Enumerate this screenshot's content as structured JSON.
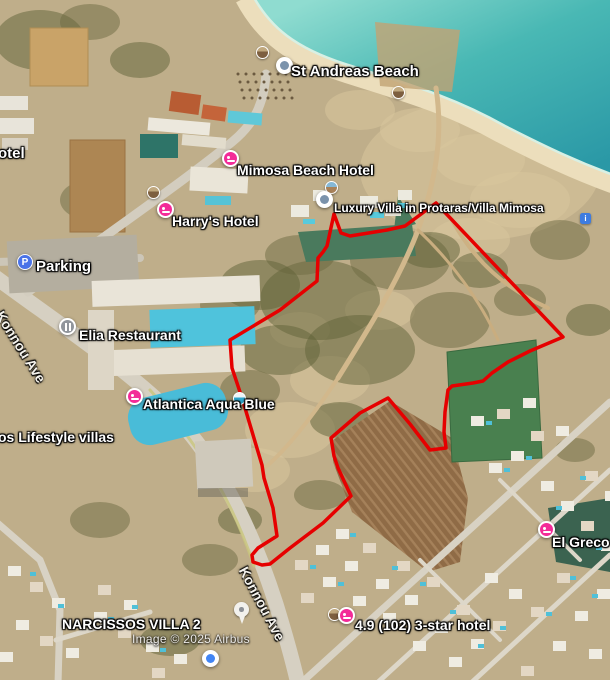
{
  "map": {
    "attribution": "Image © 2025 Airbus",
    "colors": {
      "parcel_outline": "#e60000",
      "hotel_pin": "#f32b98",
      "parking_pin": "#4a73e8",
      "restaurant_pin": "#90959c",
      "info_icon": "#3e7ce0",
      "sea_deep": "#2a98a6",
      "sea_shallow": "#8fdcd0",
      "terrain": "#bfae8a"
    },
    "parcel": {
      "points": [
        [
          436,
          203
        ],
        [
          563,
          337
        ],
        [
          530,
          351
        ],
        [
          508,
          362
        ],
        [
          492,
          373
        ],
        [
          483,
          381
        ],
        [
          473,
          383
        ],
        [
          452,
          386
        ],
        [
          448,
          390
        ],
        [
          445,
          412
        ],
        [
          444,
          432
        ],
        [
          446,
          448
        ],
        [
          430,
          450
        ],
        [
          410,
          424
        ],
        [
          388,
          398
        ],
        [
          360,
          413
        ],
        [
          331,
          438
        ],
        [
          334,
          456
        ],
        [
          338,
          468
        ],
        [
          351,
          496
        ],
        [
          323,
          523
        ],
        [
          290,
          548
        ],
        [
          270,
          564
        ],
        [
          262,
          565
        ],
        [
          253,
          562
        ],
        [
          252,
          555
        ],
        [
          258,
          548
        ],
        [
          277,
          536
        ],
        [
          273,
          508
        ],
        [
          264,
          478
        ],
        [
          262,
          465
        ],
        [
          242,
          398
        ],
        [
          232,
          368
        ],
        [
          230,
          340
        ],
        [
          280,
          310
        ],
        [
          317,
          281
        ],
        [
          318,
          258
        ],
        [
          323,
          252
        ],
        [
          327,
          246
        ],
        [
          334,
          214
        ],
        [
          341,
          233
        ],
        [
          350,
          236
        ],
        [
          387,
          230
        ],
        [
          405,
          226
        ]
      ]
    },
    "poi_labels": [
      {
        "id": "hotel-name-partial",
        "text": "otel",
        "x": -2,
        "y": 145,
        "size": 15
      },
      {
        "id": "st-andreas-beach",
        "text": "St Andreas Beach",
        "x": 291,
        "y": 63,
        "size": 15
      },
      {
        "id": "mimosa-beach-hotel",
        "text": "Mimosa Beach Hotel",
        "x": 237,
        "y": 162,
        "size": 14
      },
      {
        "id": "harrys-hotel",
        "text": "Harry's Hotel",
        "x": 172,
        "y": 213,
        "size": 14
      },
      {
        "id": "luxury-villa-protaras",
        "text": "Luxury Villa in Protaras/Villa Mimosa",
        "x": 334,
        "y": 201,
        "size": 12
      },
      {
        "id": "parking",
        "text": "Parking",
        "x": 36,
        "y": 258,
        "size": 15
      },
      {
        "id": "elia-restaurant",
        "text": "Elia Restaurant",
        "x": 79,
        "y": 327,
        "size": 14
      },
      {
        "id": "atlantica-aqua-blue",
        "text": "Atlantica Aqua Blue",
        "x": 143,
        "y": 396,
        "size": 14
      },
      {
        "id": "lifestyle-villas-partial",
        "text": "os Lifestyle villas",
        "x": -2,
        "y": 429,
        "size": 14
      },
      {
        "id": "el-greco",
        "text": "El Greco",
        "x": 552,
        "y": 534,
        "size": 14
      },
      {
        "id": "narcissos-villa-2",
        "text": "NARCISSOS VILLA 2",
        "x": 62,
        "y": 616,
        "size": 14
      },
      {
        "id": "three-star-hotel-rating",
        "text": "4.9 (102) 3-star hotel",
        "x": 355,
        "y": 617,
        "size": 14
      }
    ],
    "street_labels": [
      {
        "id": "konnou-ave-upper",
        "text": "Konnou Ave",
        "x": 6,
        "y": 308,
        "angle": 58
      },
      {
        "id": "konnou-ave-lower",
        "text": "Konnou Ave",
        "x": 250,
        "y": 564,
        "angle": 62
      }
    ],
    "icons": [
      {
        "name": "photo-thumbnail-icon",
        "variant": "sand",
        "x": 256,
        "y": 46
      },
      {
        "name": "photo-sphere-icon",
        "variant": "",
        "x": 276,
        "y": 57
      },
      {
        "name": "photo-thumbnail-icon",
        "variant": "sand",
        "x": 392,
        "y": 86
      },
      {
        "name": "hotel-pin-icon",
        "variant": "",
        "x": 222,
        "y": 150
      },
      {
        "name": "photo-thumbnail-icon",
        "variant": "sand",
        "x": 147,
        "y": 186
      },
      {
        "name": "hotel-pin-icon",
        "variant": "",
        "x": 157,
        "y": 201
      },
      {
        "name": "photo-thumbnail-icon",
        "variant": "",
        "x": 325,
        "y": 181
      },
      {
        "name": "photo-sphere-icon",
        "variant": "",
        "x": 316,
        "y": 191
      },
      {
        "name": "parking-pin-icon",
        "variant": "",
        "x": 17,
        "y": 254,
        "glyph": "P"
      },
      {
        "name": "restaurant-pin-icon",
        "variant": "",
        "x": 59,
        "y": 318
      },
      {
        "name": "hotel-pin-icon",
        "variant": "",
        "x": 126,
        "y": 388
      },
      {
        "name": "photo-thumbnail-icon",
        "variant": "pool",
        "x": 233,
        "y": 392
      },
      {
        "name": "info-icon",
        "variant": "",
        "x": 580,
        "y": 213,
        "glyph": "i"
      },
      {
        "name": "hotel-pin-icon",
        "variant": "",
        "x": 538,
        "y": 521
      },
      {
        "name": "map-pin-icon",
        "variant": "",
        "x": 234,
        "y": 602
      },
      {
        "name": "photo-thumbnail-icon",
        "variant": "sand",
        "x": 328,
        "y": 608
      },
      {
        "name": "hotel-pin-icon",
        "variant": "",
        "x": 338,
        "y": 607
      },
      {
        "name": "photo-sphere-icon",
        "variant": "blue",
        "x": 202,
        "y": 650
      }
    ]
  }
}
